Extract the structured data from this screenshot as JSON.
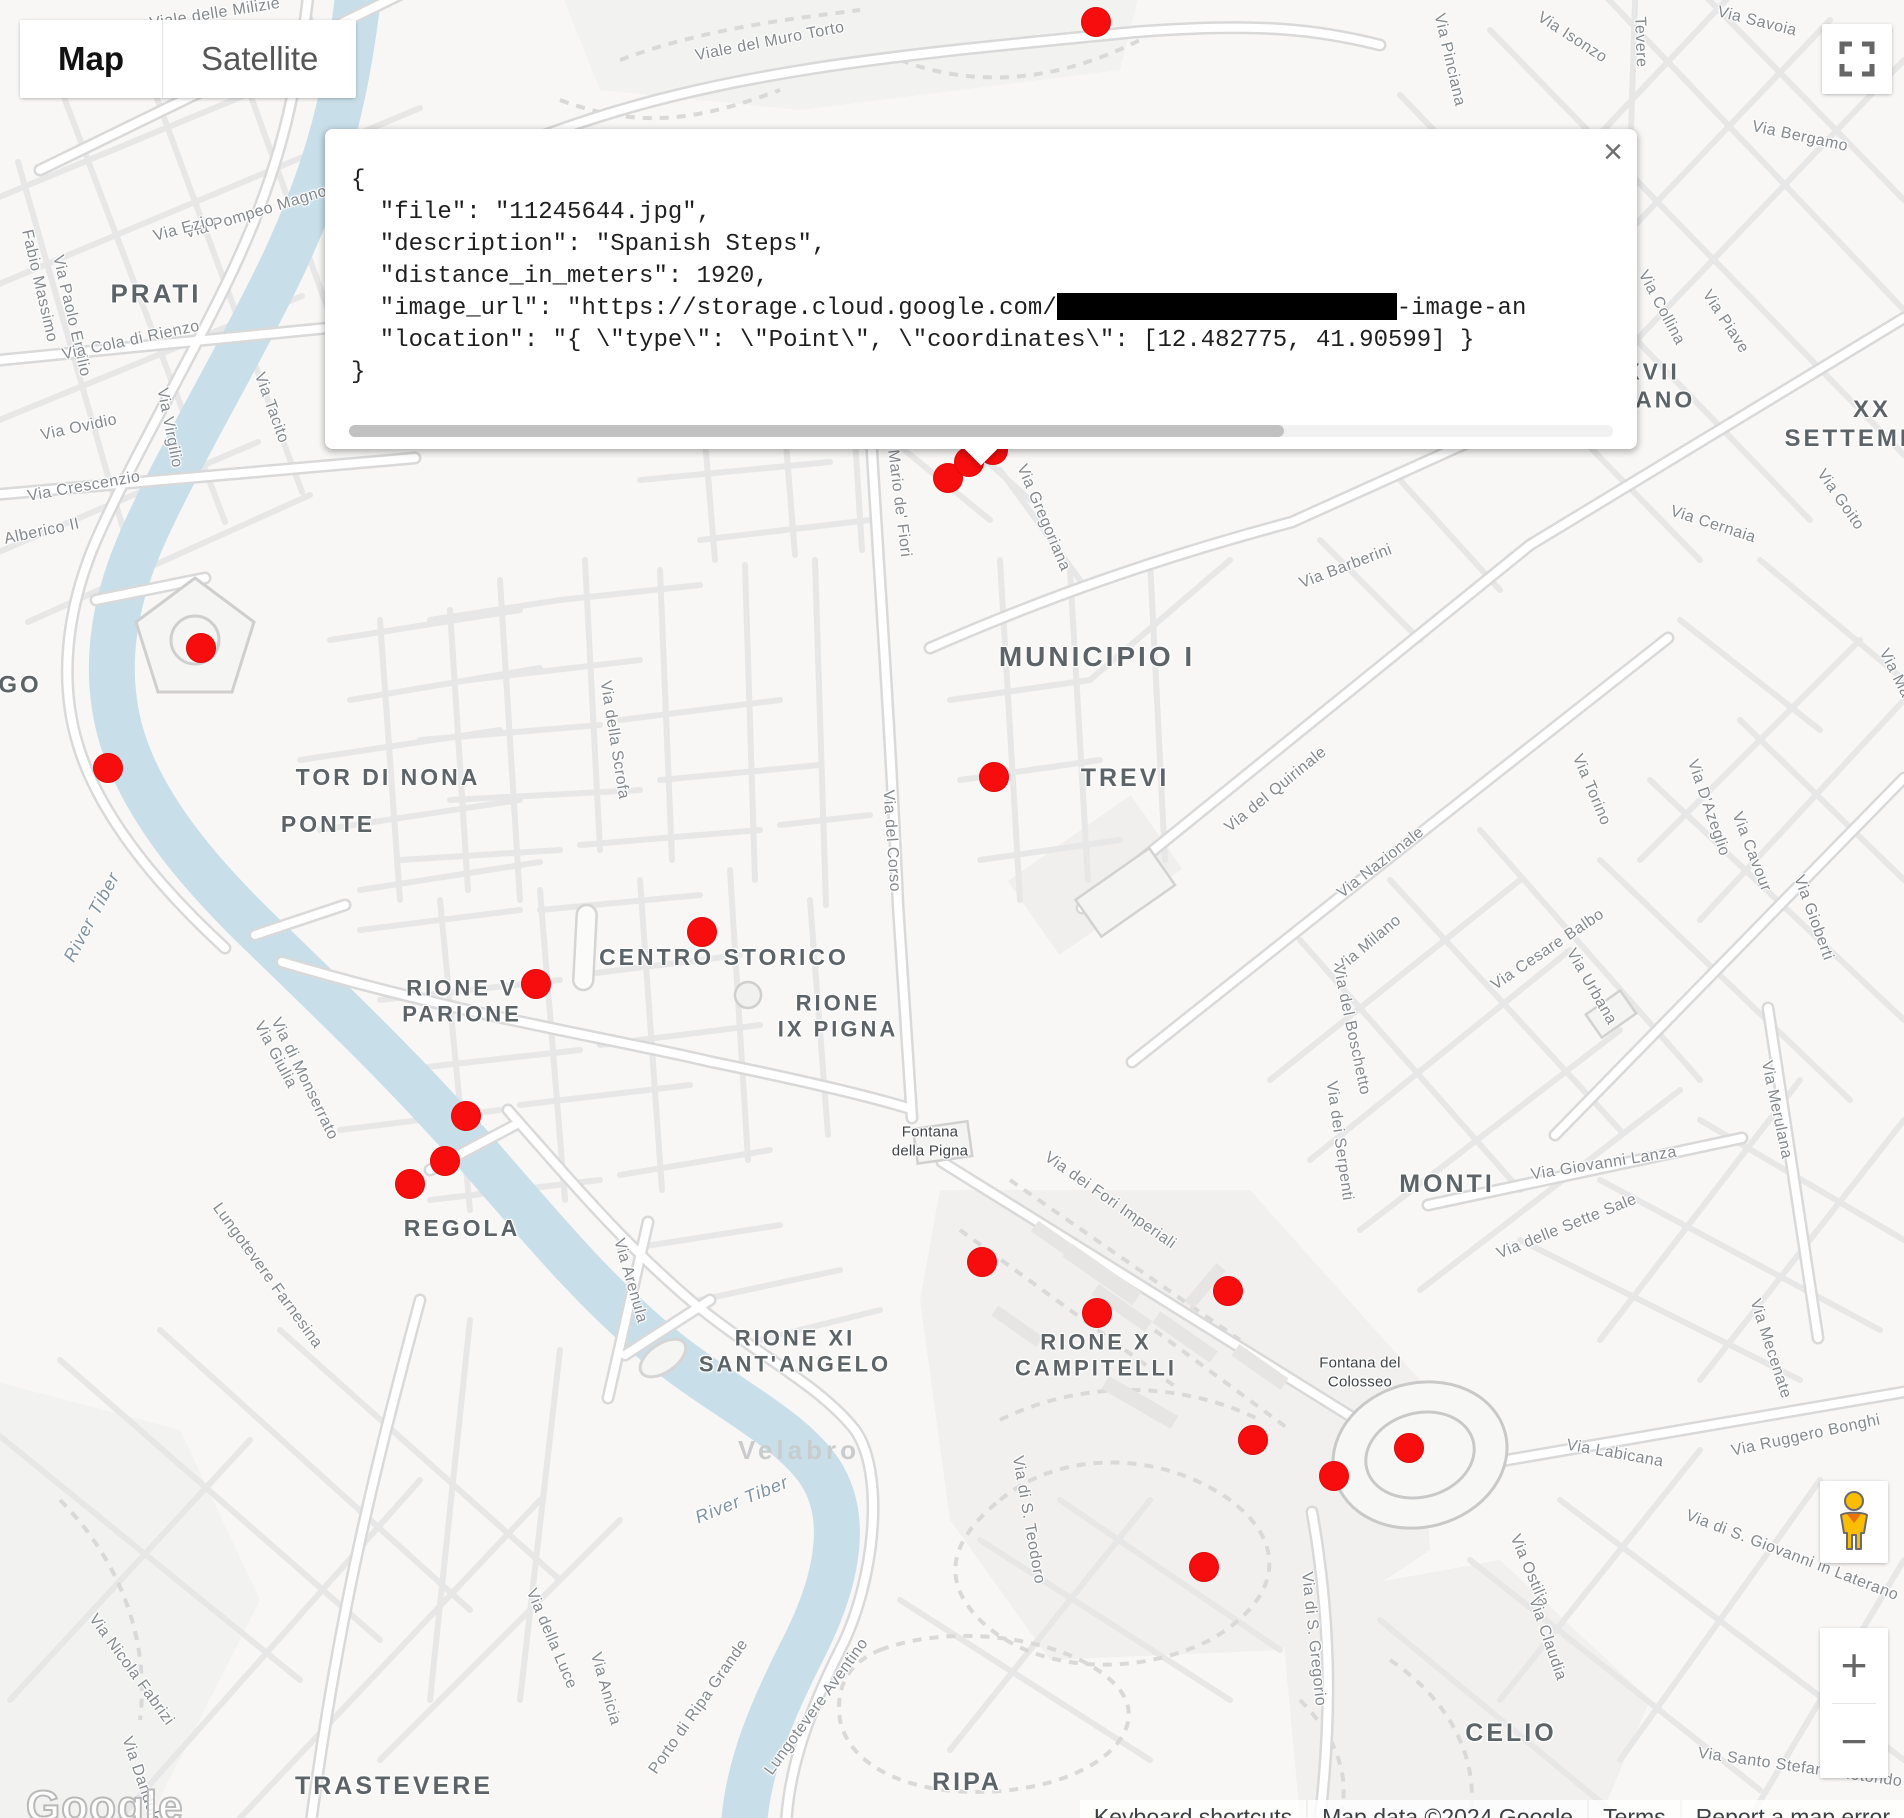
{
  "map_controls": {
    "map_type": {
      "map": "Map",
      "satellite": "Satellite"
    },
    "zoom_in": "+",
    "zoom_out": "−",
    "fullscreen_icon": "fullscreen-icon",
    "pegman_icon": "pegman-street-view-icon"
  },
  "info_window": {
    "close_icon": "×",
    "lines": [
      "{",
      "  \"file\": \"11245644.jpg\",",
      "  \"description\": \"Spanish Steps\",",
      "  \"distance_in_meters\": 1920,",
      {
        "prefix": "  \"image_url\": \"https://storage.cloud.google.com/",
        "redacted_px": 340,
        "suffix": "-image-an"
      },
      "  \"location\": \"{ \\\"type\\\": \\\"Point\\\", \\\"coordinates\\\": [12.482775, 41.90599] }",
      "}"
    ],
    "scrollbar": {
      "thumb_fraction": 0.74
    }
  },
  "markers": {
    "color": "#f70d0d",
    "radius": 15,
    "points": [
      [
        1096,
        22
      ],
      [
        948,
        478
      ],
      [
        969,
        462
      ],
      [
        993,
        450
      ],
      [
        201,
        648
      ],
      [
        108,
        768
      ],
      [
        994,
        777
      ],
      [
        702,
        932
      ],
      [
        536,
        984
      ],
      [
        466,
        1116
      ],
      [
        445,
        1161
      ],
      [
        410,
        1184
      ],
      [
        982,
        1262
      ],
      [
        1228,
        1291
      ],
      [
        1097,
        1313
      ],
      [
        1253,
        1440
      ],
      [
        1409,
        1448
      ],
      [
        1334,
        1476
      ],
      [
        1204,
        1567
      ]
    ]
  },
  "labels": {
    "districts": [
      {
        "t": "PRATI",
        "x": 156,
        "y": 294,
        "s": 26
      },
      {
        "t": "GO",
        "x": 20,
        "y": 686,
        "s": 24
      },
      {
        "t": "TOR DI NONA",
        "x": 388,
        "y": 778,
        "s": 23
      },
      {
        "t": "PONTE",
        "x": 328,
        "y": 825,
        "s": 23
      },
      {
        "t": "MUNICIPIO I",
        "x": 1097,
        "y": 657,
        "s": 28
      },
      {
        "t": "TREVI",
        "x": 1125,
        "y": 778,
        "s": 25
      },
      {
        "t": "CENTRO STORICO",
        "x": 724,
        "y": 958,
        "s": 23
      },
      {
        "t": "RIONE V\nPARIONE",
        "x": 462,
        "y": 1002,
        "s": 22
      },
      {
        "t": "RIONE\nIX PIGNA",
        "x": 838,
        "y": 1017,
        "s": 22
      },
      {
        "t": "REGOLA",
        "x": 462,
        "y": 1229,
        "s": 23
      },
      {
        "t": "MONTI",
        "x": 1447,
        "y": 1184,
        "s": 25
      },
      {
        "t": "RIONE XI\nSANT'ANGELO",
        "x": 795,
        "y": 1352,
        "s": 22
      },
      {
        "t": "RIONE X\nCAMPITELLI",
        "x": 1096,
        "y": 1356,
        "s": 22
      },
      {
        "t": "CELIO",
        "x": 1511,
        "y": 1733,
        "s": 25
      },
      {
        "t": "TRASTEVERE",
        "x": 394,
        "y": 1786,
        "s": 25
      },
      {
        "t": "RIPA",
        "x": 967,
        "y": 1782,
        "s": 25
      },
      {
        "t": "XVII\nTIANO",
        "x": 1652,
        "y": 386,
        "s": 23
      },
      {
        "t": "XX SETTEMBRE",
        "x": 1872,
        "y": 425,
        "s": 24
      }
    ],
    "streets": [
      {
        "t": "Viale delle Milizie",
        "x": 215,
        "y": 14,
        "r": -9
      },
      {
        "t": "Viale del Muro Torto",
        "x": 770,
        "y": 42,
        "r": -11
      },
      {
        "t": "Via Pinciana",
        "x": 1449,
        "y": 60,
        "r": 77
      },
      {
        "t": "Via Isonzo",
        "x": 1572,
        "y": 38,
        "r": 33
      },
      {
        "t": "Tevere",
        "x": 1640,
        "y": 42,
        "r": 88
      },
      {
        "t": "Via Savoia",
        "x": 1757,
        "y": 22,
        "r": 14
      },
      {
        "t": "Via Bergamo",
        "x": 1800,
        "y": 137,
        "r": 12
      },
      {
        "t": "Via Piave",
        "x": 1725,
        "y": 322,
        "r": 57
      },
      {
        "t": "Via Collina",
        "x": 1661,
        "y": 308,
        "r": 62
      },
      {
        "t": "Via Goito",
        "x": 1840,
        "y": 500,
        "r": 55
      },
      {
        "t": "Via Cernaia",
        "x": 1713,
        "y": 525,
        "r": 18
      },
      {
        "t": "Via Marsala",
        "x": 1903,
        "y": 690,
        "r": 63
      },
      {
        "t": "Via Pompeo Magno",
        "x": 256,
        "y": 213,
        "r": -17
      },
      {
        "t": "Via Ezio",
        "x": 184,
        "y": 229,
        "r": -15
      },
      {
        "t": "Fabio Massimo",
        "x": 39,
        "y": 286,
        "r": 77
      },
      {
        "t": "Via Paolo Emilio",
        "x": 71,
        "y": 316,
        "r": 77
      },
      {
        "t": "Via Cola di Rienzo",
        "x": 131,
        "y": 341,
        "r": -12
      },
      {
        "t": "Via Ovidio",
        "x": 79,
        "y": 428,
        "r": -12
      },
      {
        "t": "Via Virgilio",
        "x": 169,
        "y": 428,
        "r": 79
      },
      {
        "t": "Via Tacito",
        "x": 271,
        "y": 408,
        "r": 70
      },
      {
        "t": "Via Crescenzio",
        "x": 84,
        "y": 487,
        "r": -10
      },
      {
        "t": "Alberico II",
        "x": 42,
        "y": 532,
        "r": -12
      },
      {
        "t": "Via della Scrofa",
        "x": 614,
        "y": 740,
        "r": 81
      },
      {
        "t": "Via del Corso",
        "x": 891,
        "y": 841,
        "r": 86
      },
      {
        "t": "Via Mario de' Fiori",
        "x": 897,
        "y": 489,
        "r": 83
      },
      {
        "t": "Via Gregoriana",
        "x": 1043,
        "y": 518,
        "r": 67
      },
      {
        "t": "Via Barberini",
        "x": 1346,
        "y": 567,
        "r": -21
      },
      {
        "t": "Via del Quirinale",
        "x": 1276,
        "y": 790,
        "r": -39
      },
      {
        "t": "Via Nazionale",
        "x": 1381,
        "y": 863,
        "r": -38
      },
      {
        "t": "Via Milano",
        "x": 1369,
        "y": 944,
        "r": -40
      },
      {
        "t": "Via del Boschetto",
        "x": 1351,
        "y": 1030,
        "r": 78
      },
      {
        "t": "Via dei Serpenti",
        "x": 1339,
        "y": 1141,
        "r": 82
      },
      {
        "t": "Via Cesare Balbo",
        "x": 1548,
        "y": 950,
        "r": -34
      },
      {
        "t": "Via Torino",
        "x": 1591,
        "y": 790,
        "r": 67
      },
      {
        "t": "Via D'Azeglio",
        "x": 1708,
        "y": 808,
        "r": 71
      },
      {
        "t": "Via Cavour",
        "x": 1751,
        "y": 852,
        "r": 69
      },
      {
        "t": "Via Urbana",
        "x": 1591,
        "y": 987,
        "r": 60
      },
      {
        "t": "Via Gioberti",
        "x": 1813,
        "y": 918,
        "r": 70
      },
      {
        "t": "Via Giovanni Lanza",
        "x": 1604,
        "y": 1164,
        "r": -9
      },
      {
        "t": "Via delle Sette Sale",
        "x": 1567,
        "y": 1227,
        "r": -22
      },
      {
        "t": "Via Merulana",
        "x": 1776,
        "y": 1110,
        "r": 78
      },
      {
        "t": "Via Mecenate",
        "x": 1770,
        "y": 1349,
        "r": 72
      },
      {
        "t": "Via Giulia",
        "x": 275,
        "y": 1055,
        "r": 62
      },
      {
        "t": "Via di Monserrato",
        "x": 304,
        "y": 1079,
        "r": 64
      },
      {
        "t": "Lungotevere Farnesina",
        "x": 267,
        "y": 1276,
        "r": 54
      },
      {
        "t": "Via Arenula",
        "x": 630,
        "y": 1281,
        "r": 74
      },
      {
        "t": "Via dei Fori Imperiali",
        "x": 1110,
        "y": 1201,
        "r": 35
      },
      {
        "t": "Via di S. Teodoro",
        "x": 1028,
        "y": 1520,
        "r": 80
      },
      {
        "t": "Via Labicana",
        "x": 1615,
        "y": 1454,
        "r": 10
      },
      {
        "t": "Via Ruggero Bonghi",
        "x": 1806,
        "y": 1436,
        "r": -12
      },
      {
        "t": "Via di S. Giovanni in Laterano",
        "x": 1792,
        "y": 1556,
        "r": 21
      },
      {
        "t": "Via Ostilia",
        "x": 1529,
        "y": 1571,
        "r": 67
      },
      {
        "t": "Via Claudia",
        "x": 1547,
        "y": 1639,
        "r": 71
      },
      {
        "t": "Via di S. Gregorio",
        "x": 1313,
        "y": 1639,
        "r": 84
      },
      {
        "t": "Via Santo Stefano Rotondo",
        "x": 1800,
        "y": 1768,
        "r": 8
      },
      {
        "t": "Via della Luce",
        "x": 551,
        "y": 1639,
        "r": 67
      },
      {
        "t": "Via Anicia",
        "x": 605,
        "y": 1689,
        "r": 74
      },
      {
        "t": "Via Nicola Fabrizi",
        "x": 131,
        "y": 1670,
        "r": 54
      },
      {
        "t": "Via Dandolo",
        "x": 141,
        "y": 1781,
        "r": 71
      },
      {
        "t": "Porto di Ripa Grande",
        "x": 699,
        "y": 1707,
        "r": -55
      },
      {
        "t": "Lungotevere Aventino",
        "x": 817,
        "y": 1707,
        "r": -54
      }
    ],
    "pois": [
      {
        "t": "Fontana\ndella Pigna",
        "x": 930,
        "y": 1142
      },
      {
        "t": "Fontana del\nColosseo",
        "x": 1360,
        "y": 1373
      },
      {
        "t": "Velabro",
        "x": 799,
        "y": 1450,
        "faint": true
      }
    ],
    "water": [
      {
        "t": "River Tiber",
        "x": 92,
        "y": 917,
        "r": -62
      },
      {
        "t": "River Tiber",
        "x": 742,
        "y": 1500,
        "r": -22
      }
    ]
  },
  "attribution": {
    "items": [
      "Keyboard shortcuts",
      "Map data ©2024 Google",
      "Terms",
      "Report a map error"
    ]
  },
  "logo": "Google",
  "colors": {
    "marker_red": "#f70d0d",
    "water": "#c8dfe9",
    "road_fill": "#ffffff",
    "road_casing": "#d9d9d9"
  }
}
